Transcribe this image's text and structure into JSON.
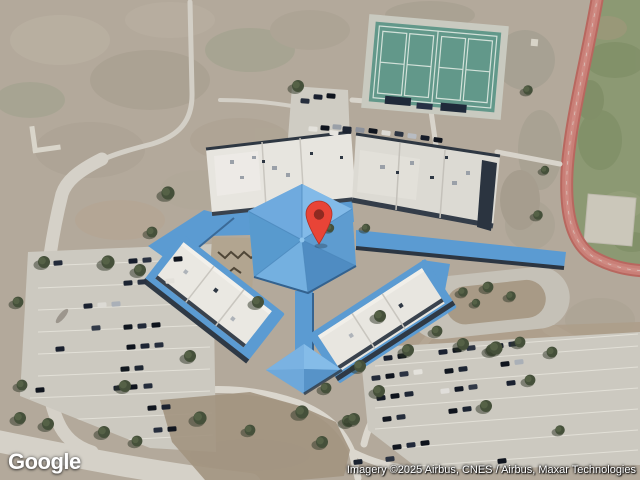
{
  "viewport": {
    "width_px": 640,
    "height_px": 480
  },
  "branding": {
    "logo_text": "Google"
  },
  "attribution": {
    "text": "Imagery ©2025 Airbus, CNES / Airbus, Maxar Technologies"
  },
  "marker": {
    "type": "map-pin",
    "fill": "#E84437",
    "outline": "#B03024",
    "dot": "#8E2A21"
  },
  "palette": {
    "roof_blue": "#5B9BD2",
    "roof_white": "#E9E7E2",
    "tennis_court": "#62988A",
    "running_track": "#C1726C",
    "infield_green": "#8C9973",
    "terrain_tan": "#B3A99B",
    "pavement": "#CCC9C0"
  }
}
